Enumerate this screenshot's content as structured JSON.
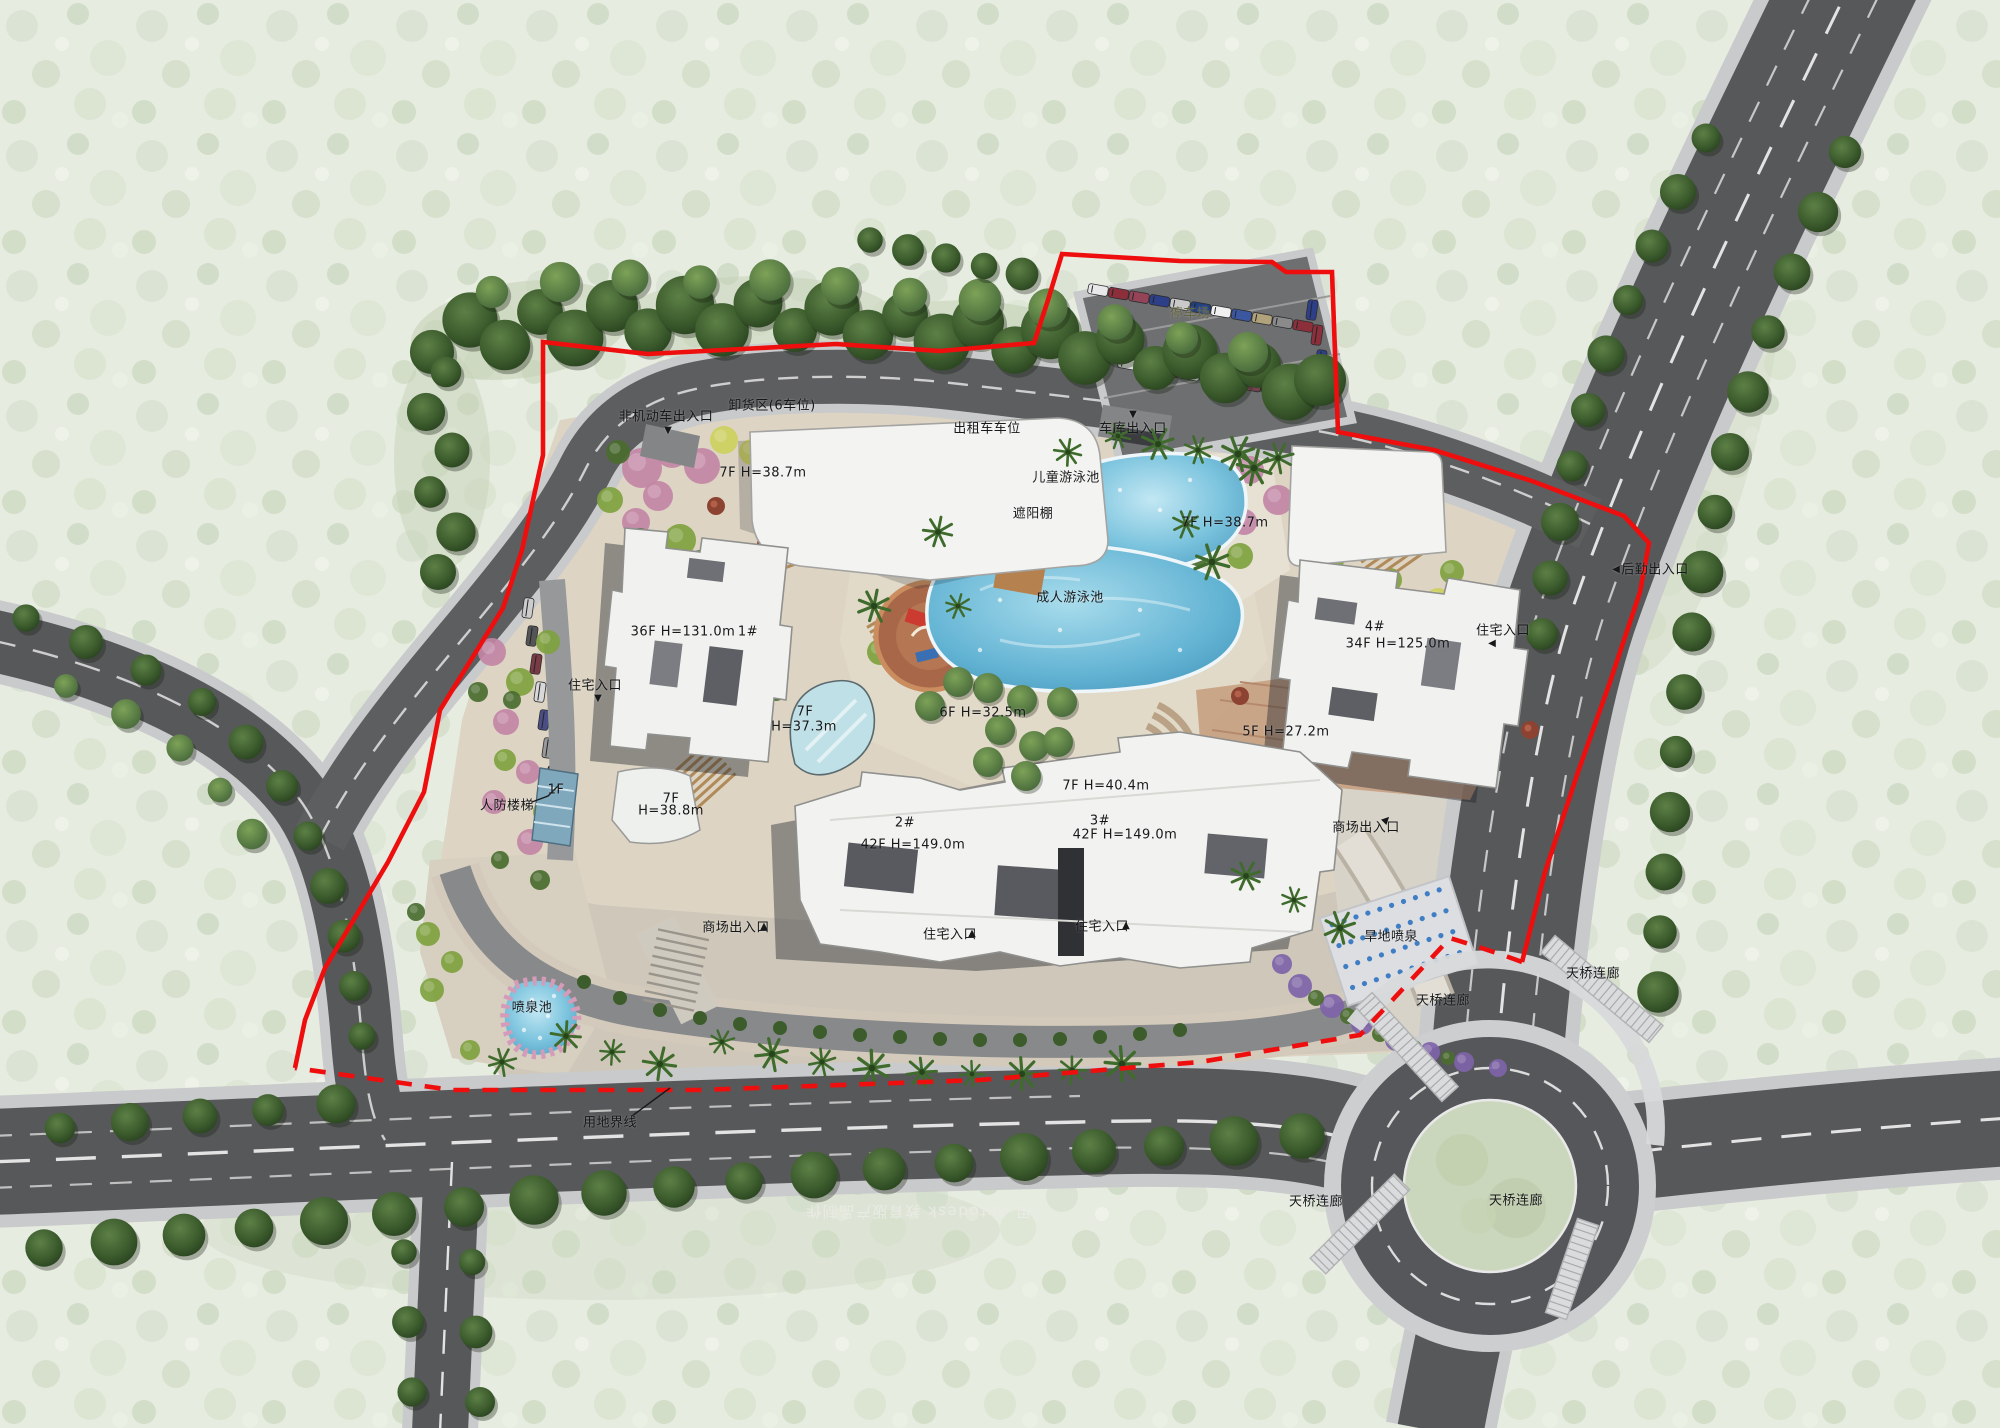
{
  "meta": {
    "type": "architectural site master plan rendering",
    "language": "zh-CN"
  },
  "colors": {
    "boundary_red": "#ee0e0e",
    "road_asphalt": "#57585a",
    "sidewalk": "#c9cacb",
    "plaza_beige": "#ddd4c4",
    "pool_blue": "#6fc0dd",
    "lawn_green": "#9ab953",
    "tree_dark_green": "#2e4a25",
    "building_white": "#f2f3f0"
  },
  "site": {
    "towers": [
      {
        "id": "1#",
        "floors": "36F",
        "height": "H=131.0m"
      },
      {
        "id": "2#",
        "floors": "42F",
        "height": "H=149.0m"
      },
      {
        "id": "3#",
        "floors": "42F",
        "height": "H=149.0m"
      },
      {
        "id": "4#",
        "floors": "34F",
        "height": "H=125.0m"
      }
    ],
    "podiums": [
      {
        "floors": "7F",
        "height": "H=38.7m"
      },
      {
        "floors": "7F",
        "height": "H=38.7m"
      },
      {
        "floors": "7F",
        "height": "H=37.3m"
      },
      {
        "floors": "6F",
        "height": "H=32.5m"
      },
      {
        "floors": "5F",
        "height": "H=27.2m"
      },
      {
        "floors": "7F",
        "height": "H=40.4m"
      },
      {
        "floors": "7F",
        "height": "H=38.8m"
      },
      {
        "floors": "1F",
        "height": ""
      }
    ],
    "amenities": [
      "儿童游泳池",
      "成人游泳池",
      "遮阳棚",
      "喷泉池",
      "旱地喷泉",
      "停车场",
      "卸货区(6车位)",
      "出租车车位",
      "人防楼梯",
      "天桥连廊",
      "用地界线"
    ],
    "entrances": [
      "非机动车出入口",
      "车库出入口",
      "商场出入口",
      "住宅入口",
      "后勤出入口"
    ]
  },
  "watermark": {
    "text": "用 Autodesk 教育版产品制作"
  },
  "labels": [
    {
      "name": "nonmotor-entrance-label",
      "text": "非机动车出入口",
      "x": 666,
      "y": 417
    },
    {
      "name": "nonmotor-arrow",
      "text": "▼",
      "x": 668,
      "y": 431,
      "arrow": true
    },
    {
      "name": "loading-area-label",
      "text": "卸货区(6车位)",
      "x": 772,
      "y": 406
    },
    {
      "name": "taxi-parking-label",
      "text": "出租车车位",
      "x": 987,
      "y": 429
    },
    {
      "name": "garage-arrow",
      "text": "▼",
      "x": 1133,
      "y": 415,
      "arrow": true
    },
    {
      "name": "garage-entrance-label",
      "text": "车库出入口",
      "x": 1133,
      "y": 429
    },
    {
      "name": "parking-lot-label",
      "text": "停车场",
      "x": 1190,
      "y": 314,
      "color": "#63653f"
    },
    {
      "name": "podium-a-spec",
      "text": "7F  H=38.7m",
      "x": 763,
      "y": 473
    },
    {
      "name": "kids-pool-label",
      "text": "儿童游泳池",
      "x": 1066,
      "y": 478
    },
    {
      "name": "pergola-label",
      "text": "遮阳棚",
      "x": 1033,
      "y": 514
    },
    {
      "name": "podium-b-spec",
      "text": "7F  H=38.7m",
      "x": 1225,
      "y": 523
    },
    {
      "name": "adult-pool-label",
      "text": "成人游泳池",
      "x": 1070,
      "y": 598
    },
    {
      "name": "tower1-spec",
      "text": "36F  H=131.0m",
      "x": 683,
      "y": 632
    },
    {
      "name": "tower1-id",
      "text": "1#",
      "x": 748,
      "y": 632
    },
    {
      "name": "tower4-id",
      "text": "4#",
      "x": 1375,
      "y": 627
    },
    {
      "name": "tower4-spec",
      "text": "34F  H=125.0m",
      "x": 1398,
      "y": 644
    },
    {
      "name": "residence-entrance-right-label",
      "text": "住宅入口",
      "x": 1503,
      "y": 631
    },
    {
      "name": "residence-entrance-right-arrow",
      "text": "◀",
      "x": 1492,
      "y": 644,
      "arrow": true
    },
    {
      "name": "service-entrance-label",
      "text": "后勤出入口",
      "x": 1655,
      "y": 570
    },
    {
      "name": "service-entrance-arrow",
      "text": "◀",
      "x": 1616,
      "y": 570,
      "arrow": true
    },
    {
      "name": "residence-entrance-left-label",
      "text": "住宅入口",
      "x": 595,
      "y": 686
    },
    {
      "name": "residence-entrance-left-arrow",
      "text": "▼",
      "x": 598,
      "y": 699,
      "arrow": true
    },
    {
      "name": "atrium-floors",
      "text": "7F",
      "x": 805,
      "y": 712
    },
    {
      "name": "atrium-height",
      "text": "H=37.3m",
      "x": 804,
      "y": 727
    },
    {
      "name": "plaza-6f-spec",
      "text": "6F  H=32.5m",
      "x": 983,
      "y": 713
    },
    {
      "name": "plaza-5f-spec",
      "text": "5F  H=27.2m",
      "x": 1286,
      "y": 732
    },
    {
      "name": "bridge-7f-spec",
      "text": "7F  H=40.4m",
      "x": 1106,
      "y": 786
    },
    {
      "name": "tower2-id",
      "text": "2#",
      "x": 905,
      "y": 823
    },
    {
      "name": "tower2-spec",
      "text": "42F  H=149.0m",
      "x": 913,
      "y": 845
    },
    {
      "name": "tower3-id",
      "text": "3#",
      "x": 1100,
      "y": 821
    },
    {
      "name": "tower3-spec",
      "text": "42F  H=149.0m",
      "x": 1125,
      "y": 835
    },
    {
      "name": "civil-defense-stairs-label",
      "text": "人防楼梯",
      "x": 507,
      "y": 806
    },
    {
      "name": "left-canopy-1f",
      "text": "1F",
      "x": 556,
      "y": 790
    },
    {
      "name": "left-podium-floors",
      "text": "7F",
      "x": 671,
      "y": 799
    },
    {
      "name": "left-podium-height",
      "text": "H=38.8m",
      "x": 671,
      "y": 811
    },
    {
      "name": "mall-entrance-bottom-label",
      "text": "商场出入口",
      "x": 736,
      "y": 928
    },
    {
      "name": "mall-entrance-bottom-arrow",
      "text": "▲",
      "x": 764,
      "y": 927,
      "arrow": true
    },
    {
      "name": "residence-entrance-b1-label",
      "text": "住宅入口",
      "x": 950,
      "y": 935
    },
    {
      "name": "residence-entrance-b1-arrow",
      "text": "▲",
      "x": 972,
      "y": 934,
      "arrow": true
    },
    {
      "name": "residence-entrance-b2-label",
      "text": "住宅入口",
      "x": 1102,
      "y": 927
    },
    {
      "name": "residence-entrance-b2-arrow",
      "text": "▲",
      "x": 1126,
      "y": 926,
      "arrow": true
    },
    {
      "name": "mall-entrance-right-label",
      "text": "商场出入口",
      "x": 1366,
      "y": 828
    },
    {
      "name": "mall-entrance-right-arrow",
      "text": "▲",
      "x": 1386,
      "y": 820,
      "rot": 45,
      "arrow": true
    },
    {
      "name": "fountain-pool-label",
      "text": "喷泉池",
      "x": 532,
      "y": 1008
    },
    {
      "name": "dry-fountain-label",
      "text": "旱地喷泉",
      "x": 1391,
      "y": 937
    },
    {
      "name": "skybridge-nw-label",
      "text": "天桥连廊",
      "x": 1443,
      "y": 1001
    },
    {
      "name": "skybridge-ne-label",
      "text": "天桥连廊",
      "x": 1593,
      "y": 974
    },
    {
      "name": "skybridge-sw-label",
      "text": "天桥连廊",
      "x": 1316,
      "y": 1202
    },
    {
      "name": "skybridge-se-label",
      "text": "天桥连廊",
      "x": 1516,
      "y": 1201
    },
    {
      "name": "site-boundary-label",
      "text": "用地界线",
      "x": 610,
      "y": 1123
    }
  ]
}
